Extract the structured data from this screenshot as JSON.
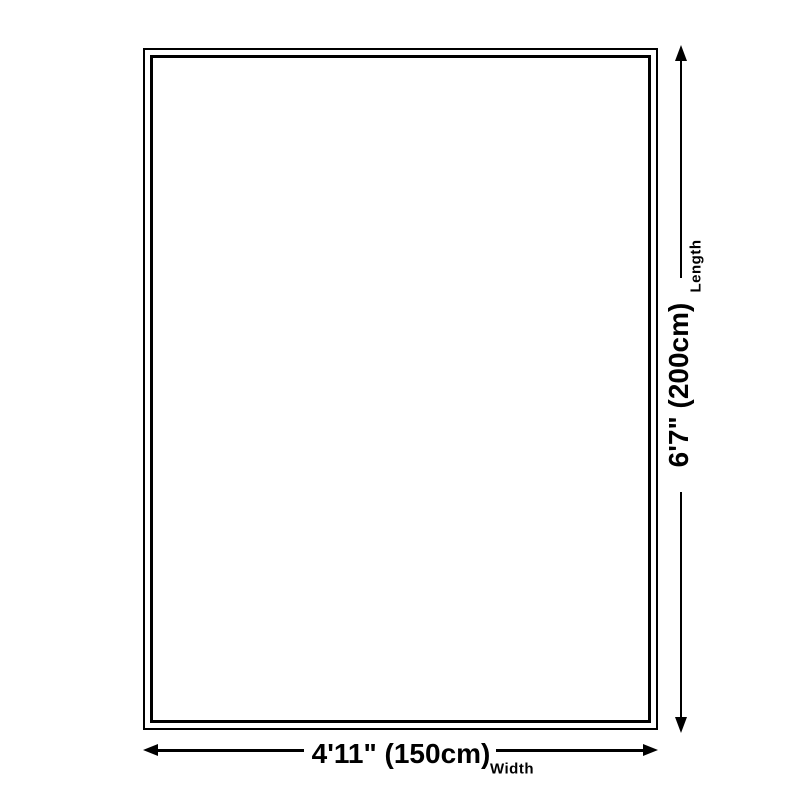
{
  "page": {
    "background_color": "#ffffff",
    "line_color": "#000000"
  },
  "diagram": {
    "type": "product-size-diagram",
    "length_dimension": {
      "value": "6'7\" (200cm)",
      "label": "Length"
    },
    "width_dimension": {
      "value": "4'11\" (150cm)",
      "label": "Width"
    }
  }
}
